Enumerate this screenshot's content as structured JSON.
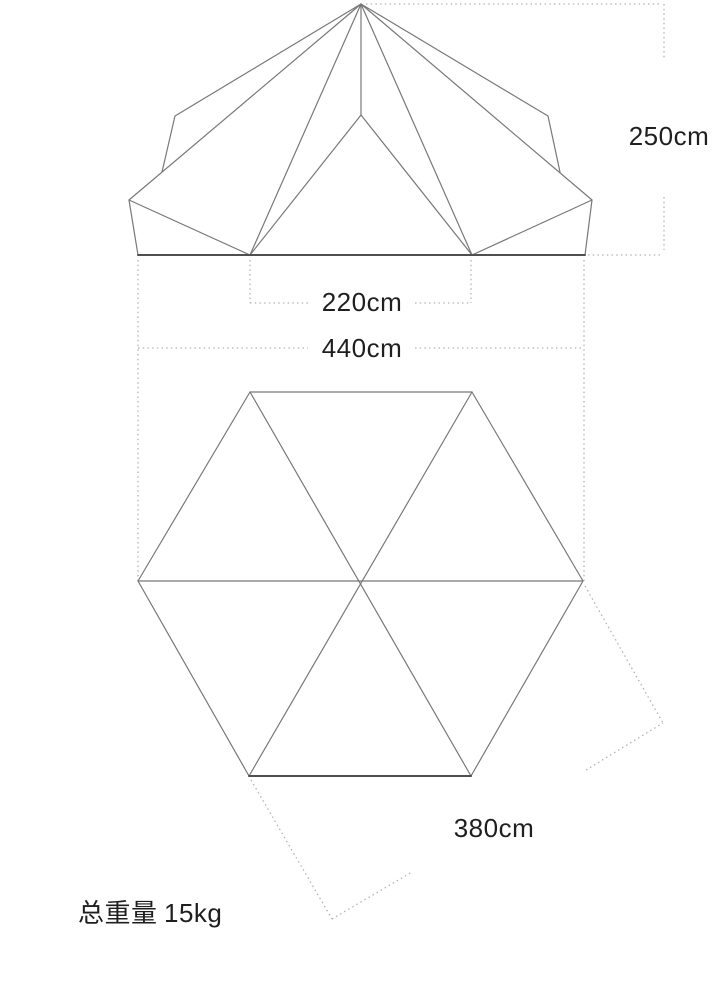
{
  "diagram": {
    "type": "tent-specification-drawing",
    "views": [
      {
        "id": "front-elevation",
        "description": "bell tent front elevation with seam lines and door"
      },
      {
        "id": "floor-plan",
        "description": "hexagonal floor plan with three diagonals"
      }
    ],
    "labels": {
      "height": "250cm",
      "inner_width": "220cm",
      "overall_width": "440cm",
      "across_flats": "380cm"
    },
    "weight": {
      "label": "总重量",
      "value": "15kg"
    },
    "dimensions_cm": {
      "height": 250,
      "inner_width": 220,
      "overall_width": 440,
      "across_flats": 380
    },
    "weight_kg": 15,
    "colors": {
      "line": "#787878",
      "heavy_line": "#4f4f4f",
      "dotted": "#b3b3b3",
      "text": "#1f1f1f",
      "background": "#ffffff"
    }
  }
}
